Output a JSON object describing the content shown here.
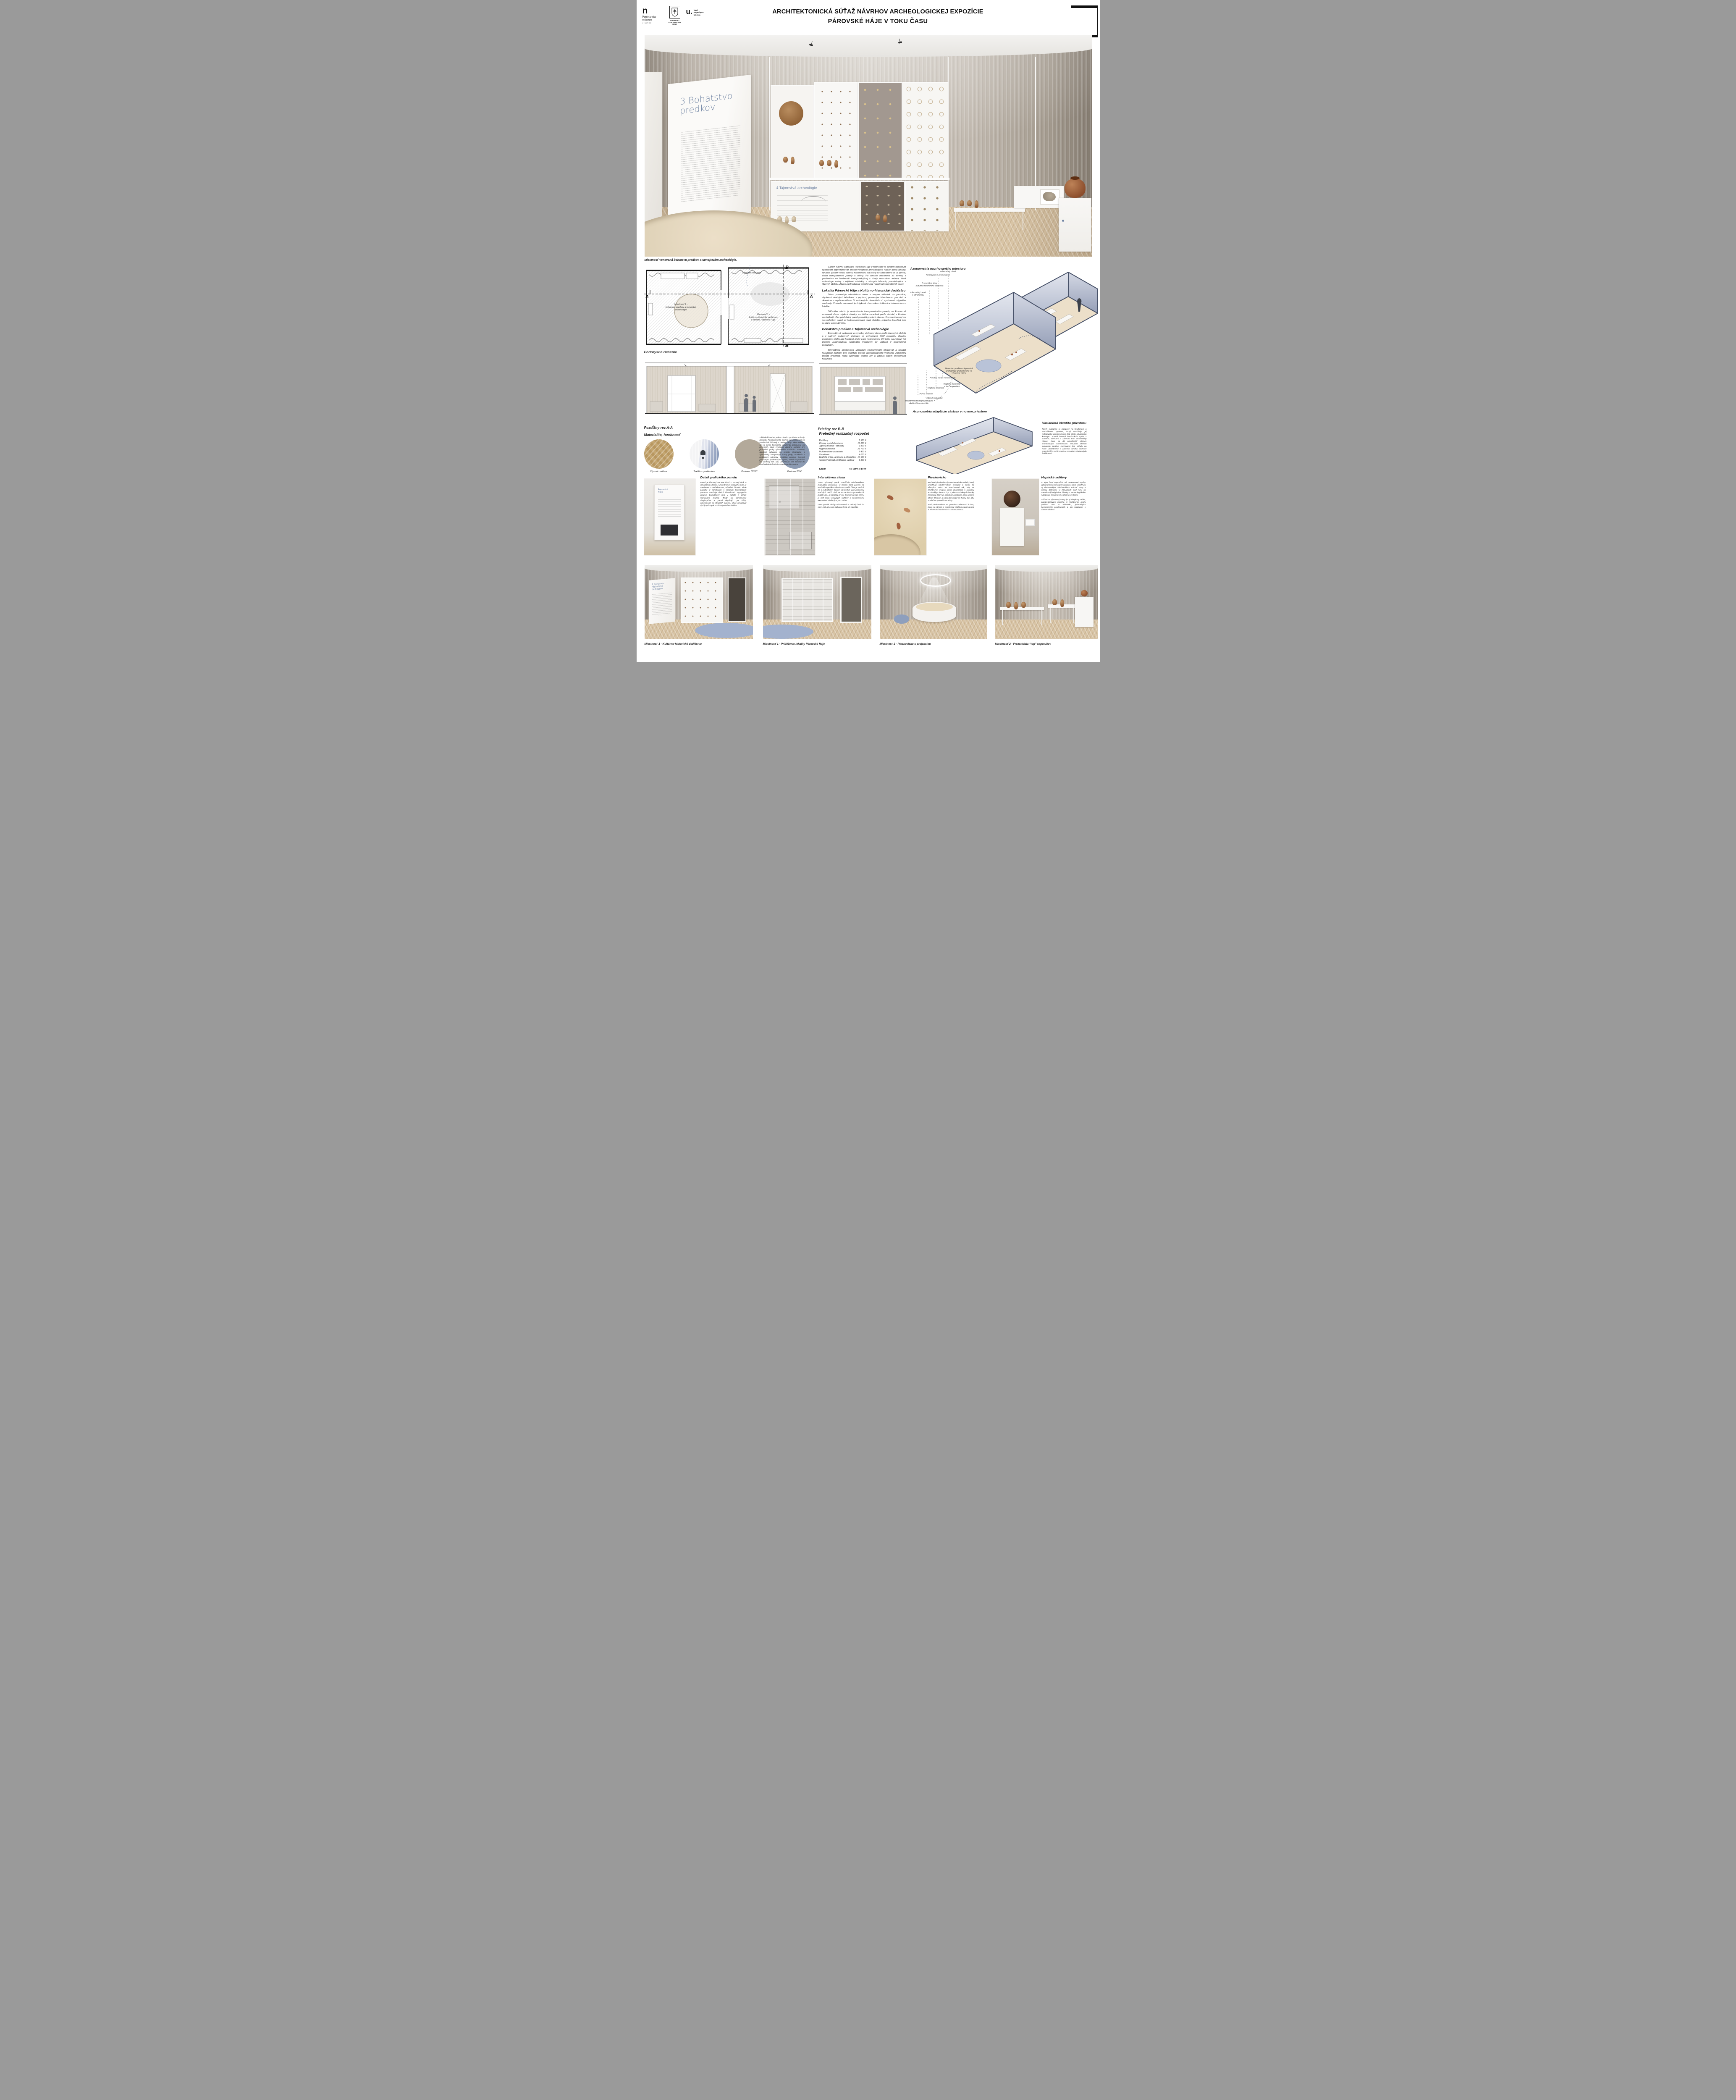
{
  "colors": {
    "accent_blue": "#7185a4",
    "clay": "#a2613f",
    "pantone_7533c": "#b3a99a",
    "pantone_289c": "#8c9bb3",
    "rug_blue": "#a3b2ce"
  },
  "header": {
    "title_line1": "ARCHITEKTONICKÁ SÚŤAŽ NÁVRHOV ARCHEOLOGICKEJ EXPOZÍCIE",
    "title_line2": "PÁROVSKÉ HÁJE V TOKU ČASU",
    "logo_muzeum_mark": "n",
    "logo_muzeum_name": "Ponitrianske\nmúzeum",
    "logo_muzeum_sub": "V NITRE",
    "logo_kraj": "NITRIANSKY\nSAMOSPRÁVNY\nKRAJ",
    "logo_fond_mark": "u.",
    "logo_fond_text": "fond\nna podporu\numenia"
  },
  "hero": {
    "panel3_title": "3 Bohatstvo\n   predkov",
    "panel4_title": "4 Tajomstvá archeológie",
    "caption": "Miestnosť venovaná bohatsvu predkov a tamojstvám archeológie."
  },
  "floorplan": {
    "caption": "Pôdorysné riešenie",
    "room2_label": "Miestnosť 2 -\nbohatstvo predkov a tamojstvá\narcheológie",
    "room1_label": "Miestnosť 1 -\nkultúrno-historické dedičstvo\na lokalita Párovské Háje",
    "entry_label": "Vstup do expozície",
    "marker_a": "A",
    "marker_b": "B"
  },
  "col": {
    "intro": "Cieľom návrhu expozície Párovské Háje v toku času je sviežim súčasným spôsobom odprezentovať širokej verejnosti archeologické nálezy danej lokality. Využíva pri tom ľahkú kovovú konštrukciu, na ktorej sú umiestnené či už pevné, alebo transparentné panely a vitríny. Po obvode miestnosti sú závesy s gradientom vo farebnosti korešpondujúcej s dizajn manuálom múzea, ktorá znázorňuje vrstvy - nájdené artefakty v rôznych hĺbkach, pochádzajúce z rôznych období. Záves zjednoducuje priestor bez náročných stavebných úprav.",
    "s1_heading": "Lokalita Párovské Háje a Kultúrno-historické dedičstvo",
    "s1_p1": "Tému prezentuje interaktívna stena s mapou nálezísk na plexiskle, doplnená otočnými tabuľkami s popismi, posuvným hlavolamom pre deti a okienkom s  replikou nálezu. V zasklených zásuvkách sú vystavené originálne predmety. V strede miestnosti je dotyková obrazovka s fotkami a informáciami o lokalite.",
    "s1_p2": "Súčasťou návrhu je umiestnenie transparentného panela, na ktorom sú zavesené rôzne nájdené úlomky, vertikálne zoradené podľa období, z ktorého pochádzajú. Cez priehľadný panel presvitá gradient závesu. Formou časovej osi na vedľajšom paneli sú textovo popísané dané obdobia, prípadne špecifiká, čím sa dané exponáty líšia.",
    "s2_heading": "Bohatstvo predkov a Tajomstvá archeológie",
    "s2_p1": "Exponáty sú vystavené vo vysokej vitrínovej stene podľa časových období a v nízkych solitérnych vitrínach sú zvýraznené TOP exponáty. Repliky exponátov slúžia ako haptické prvky a po naskenovaní QR kódu sa zobrazí ich grafická rekonštrukcia. Originálne fragmenty sú uložené v osvetlených zásuvkách.",
    "s2_p2": "Interaktívne pieskovisko umožňuje návštevníkom objavovať a skladať keramické nádoby, čím približuje proces archeologického výskumu. Atmosféru dopĺňa projekcia, ktorá vysvetľuje princíp hry a vytvára dojem skutočného náleziska."
  },
  "axo1": {
    "title": "Axonometria navrhovaného priestoru",
    "labels": [
      "Informačný panel",
      "Pieskovisko s premietaním",
      "Prezentácia témy\nkultúrno-historického dedičstva",
      "Informačný panel\ns obrazovkou",
      "Bohatstvo predkov a tajomstvá\narcheológie prezentované vo\nvýstavnej vitríne",
      "Prechod medzi miestnostami",
      "Haptická keramika\ns “top” exponátmi",
      "Haptická keramika",
      "Puf na sedenie",
      "Vstup do expozície",
      "Interaktívna vitrína prezentujúca\nlokalitu Párovske Háje"
    ]
  },
  "axo2": {
    "title": "Axonometria adaptácie výstavy v novom priestore"
  },
  "sections": {
    "aa_caption": "Pozdĺžny rez A-A",
    "bb_caption": "Priečny rez B-B"
  },
  "materiality": {
    "heading": "Materialita, farebnosť",
    "para": "Základná farebná paleta návrhu vychádza z dizajn manuálu Ponitrianskeho múzea a je postavená na kombinácii béžovej a modrej farby. Tieto odtiene sú vo forme farebného gradientu aplikované na závesoch, ktoré vytvárajú vizuálne pozadie pre jednotlivé prvky výstavného mobiliáru. Farebný gradient odkazuje na princíp stratigrafie a symbolicky interpretuje vrstvy pôdy, usadenín a kultúrnych nánosov. Podlaha zostáva tvorená pôvodnými parketovými vlysmi, zatiaľ čo podhľad bol znížený tak, aby umožňoval bez zásahu do konštrukcie inštaláciu osvetľovacích prvkov.",
    "swatches": [
      {
        "label": "Vlysová podlaha"
      },
      {
        "label": "Textílie s gradientom"
      },
      {
        "label": "Pantone 7533C",
        "style": "background:#b3a99a"
      },
      {
        "label": "Pantone 289C",
        "style": "background:#8c9bb3"
      }
    ]
  },
  "budget": {
    "heading": "Prebežný realizačný rozpočet",
    "rows": [
      {
        "label": "Podhľady",
        "value": "5 500 €"
      },
      {
        "label": "Závesy s príslušenstvom",
        "value": "13 200 €"
      },
      {
        "label": "Typový mobiliár - taburety",
        "value": "1 800 €"
      },
      {
        "label": "Atypový mobiliár",
        "value": "21 700 €"
      },
      {
        "label": "Multimediálne zariadenia",
        "value": "5 400 €"
      },
      {
        "label": "Osvetlenie",
        "value": "4 000 €"
      },
      {
        "label": "Grafické práce, animácie a infografika",
        "value": "10 600 €"
      },
      {
        "label": "Autorský dohľad a inštalácia výstavy",
        "value": "3 800 €"
      }
    ],
    "total_label": "Spolu",
    "total_value": "66 000 € s DPH"
  },
  "var_identity": {
    "heading": "Variabilná identita priestoru",
    "para": "Návrh expozície je založený na flexibilnom a modulárnom systéme, ktorý umožňuje jej jednoduché premiestnenie bez straty pôvodného konceptu. Ľahká kovová konštrukcia spolu s panelmi, vitrínami a závesmi tvorí univerzálny rámec, ktorý sa dá prispôsobiť rôznym priestorovým podmienkam. Vizuálna identita expozície zostáva zachovaná bez ohľadu na nové umiestnenie a zároveň ponúka možnosť organického rozširovania v rovnakom duchu aj do budúcnosti."
  },
  "details": [
    {
      "heading": "Detail grafického panelu",
      "para1": "Panel je členený na dve časti – textový blok a interaktívny displej. Umiestnenie textového poľa je navrhnuté s ohľadom na pohodlné čítanie. Biele pozadie v kombinácii s modrým kontrastným písmom zaručuje dobrú čitateľnosť. Typografia využíva bezpätkový font v súlade s dizajn manuálom múzea. Texty sú spracované dvojjazyčne a panel dopĺňajú QR  kódy, umiestnené po stranách panelu, ktoré umožňujú rýchly prístup k rozšíreným informáciám.",
      "panel_label": "Párovské\nHáje"
    },
    {
      "heading": "Interaktívna stena",
      "para1": "Tento výstavný prvok umožňuje návštevníkom manuálnu interakciu. V hornej časti panelu sa nachádza grafika náleziska a podľa čísle je možné sa k jednotlivým bodom dovzedieť viac pomocou otočných tabúľ. Tiež sa tu nachádza jednoduchá puzzle hra, a haptický prvok. Súčasťou tejto steny je tiež séria výsuvných šuflíkov s nasvietenými exponátmi uloženými pod sklom.",
      "para2": "Obe vysoké vitríny sú kotvené v zadnej časti do stien, tak aby bola zabezpečená ich stabilita."
    },
    {
      "heading": "Pieskovisko",
      "para1": "Kruhové pieskovisko je navrhnuté ako solitér, ktorý umožňuje návštevníkom pristúpiť k nemu zo všetkých strán. Je navrhované tak, aby sa návštevníci múzea ľahko oboznámili s práchou archeológa formou hry. V piesku sú ukryté úlomky keramiky, ktoré je potrebné postupne nájsť, jemne očistiť štetcom a následne uložiť do formy tak, aby spoločne vytvorili tvar vázy.",
      "para2": "Nad pieskoviskom sa premieta inštruktáž k hre, ktorá sa strieda s projekciou ďalších zaujímavostí a informácií súvisiacich s danou témou."
    },
    {
      "heading": "Haptické solitéry",
      "para1": "V tejto časti expozície sú umiestnené repliky vybraných keramických nálezov, ktoré umožňujú aj slabozrakým návštevníkom vnímať tvary a detaily dotykom. V zásuvkách pod nimi sa nachádzajú originálne úlomky z archeologického náleziska, nasvietené a chránené sklom.",
      "para2": "Súčasťou výstavnej steny je aj dotykový tablet, prostredníctvom ktorého si návštevníci môžu prečítať viac o nálezisku, jednotlivých keramických predmetoch a ich využívaní v danom období."
    }
  ],
  "renders": [
    {
      "caption": "Miestnosť 1 -  Kultúrno-historické dedičstvo",
      "panel_label": "2 Kultúrno-\nHistorické\ndedičstvo"
    },
    {
      "caption": "Miestnosť 1 -  Priblíženie lokality Párovské Háje"
    },
    {
      "caption": "Miestnosť 2 -  Pieskovisko s projekciou"
    },
    {
      "caption": "Miestnosť 2 -  Prezentácia “top” exponátov"
    }
  ]
}
